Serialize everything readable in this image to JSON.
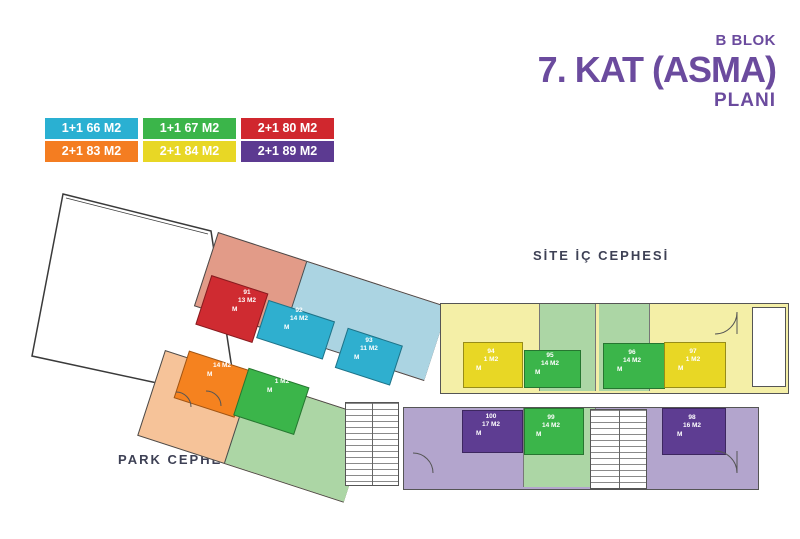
{
  "title": {
    "block": "B BLOK",
    "floor": "7. KAT (ASMA)",
    "plan": "PLANI",
    "color": "#6b4b9e"
  },
  "legend": {
    "items": [
      {
        "label": "1+1 66 M2",
        "color": "#2ab0d2"
      },
      {
        "label": "1+1 67 M2",
        "color": "#3bb54a"
      },
      {
        "label": "2+1 80 M2",
        "color": "#d0272e"
      },
      {
        "label": "2+1 83 M2",
        "color": "#f47d21"
      },
      {
        "label": "2+1 84 M2",
        "color": "#e8d725"
      },
      {
        "label": "2+1 89 M2",
        "color": "#5c3a91"
      }
    ]
  },
  "plan": {
    "facade_labels": {
      "inner": "SİTE İÇ CEPHESİ",
      "park": "PARK CEPHESİ"
    },
    "units": [
      {
        "no": "89",
        "area": "1 M2",
        "mezzanine": "M",
        "color": "#3bb54a"
      },
      {
        "no": "90",
        "area": "14 M2",
        "mezzanine": "M",
        "color": "#f5821f"
      },
      {
        "no": "91",
        "area": "13 M2",
        "mezzanine": "M",
        "color": "#cf2b31"
      },
      {
        "no": "92",
        "area": "14 M2",
        "mezzanine": "M",
        "color": "#2fafcf"
      },
      {
        "no": "93",
        "area": "11 M2",
        "mezzanine": "M",
        "color": "#2fafcf"
      },
      {
        "no": "94",
        "area": "1 M2",
        "mezzanine": "M",
        "color": "#e8d725"
      },
      {
        "no": "95",
        "area": "14 M2",
        "mezzanine": "M",
        "color": "#3bb54a"
      },
      {
        "no": "96",
        "area": "14 M2",
        "mezzanine": "M",
        "color": "#3bb54a"
      },
      {
        "no": "97",
        "area": "1 M2",
        "mezzanine": "M",
        "color": "#e8d725"
      },
      {
        "no": "98",
        "area": "16 M2",
        "mezzanine": "M",
        "color": "#5e3d92"
      },
      {
        "no": "99",
        "area": "14 M2",
        "mezzanine": "M",
        "color": "#3bb54a"
      },
      {
        "no": "100",
        "area": "17 M2",
        "mezzanine": "M",
        "color": "#5e3d92"
      }
    ]
  }
}
